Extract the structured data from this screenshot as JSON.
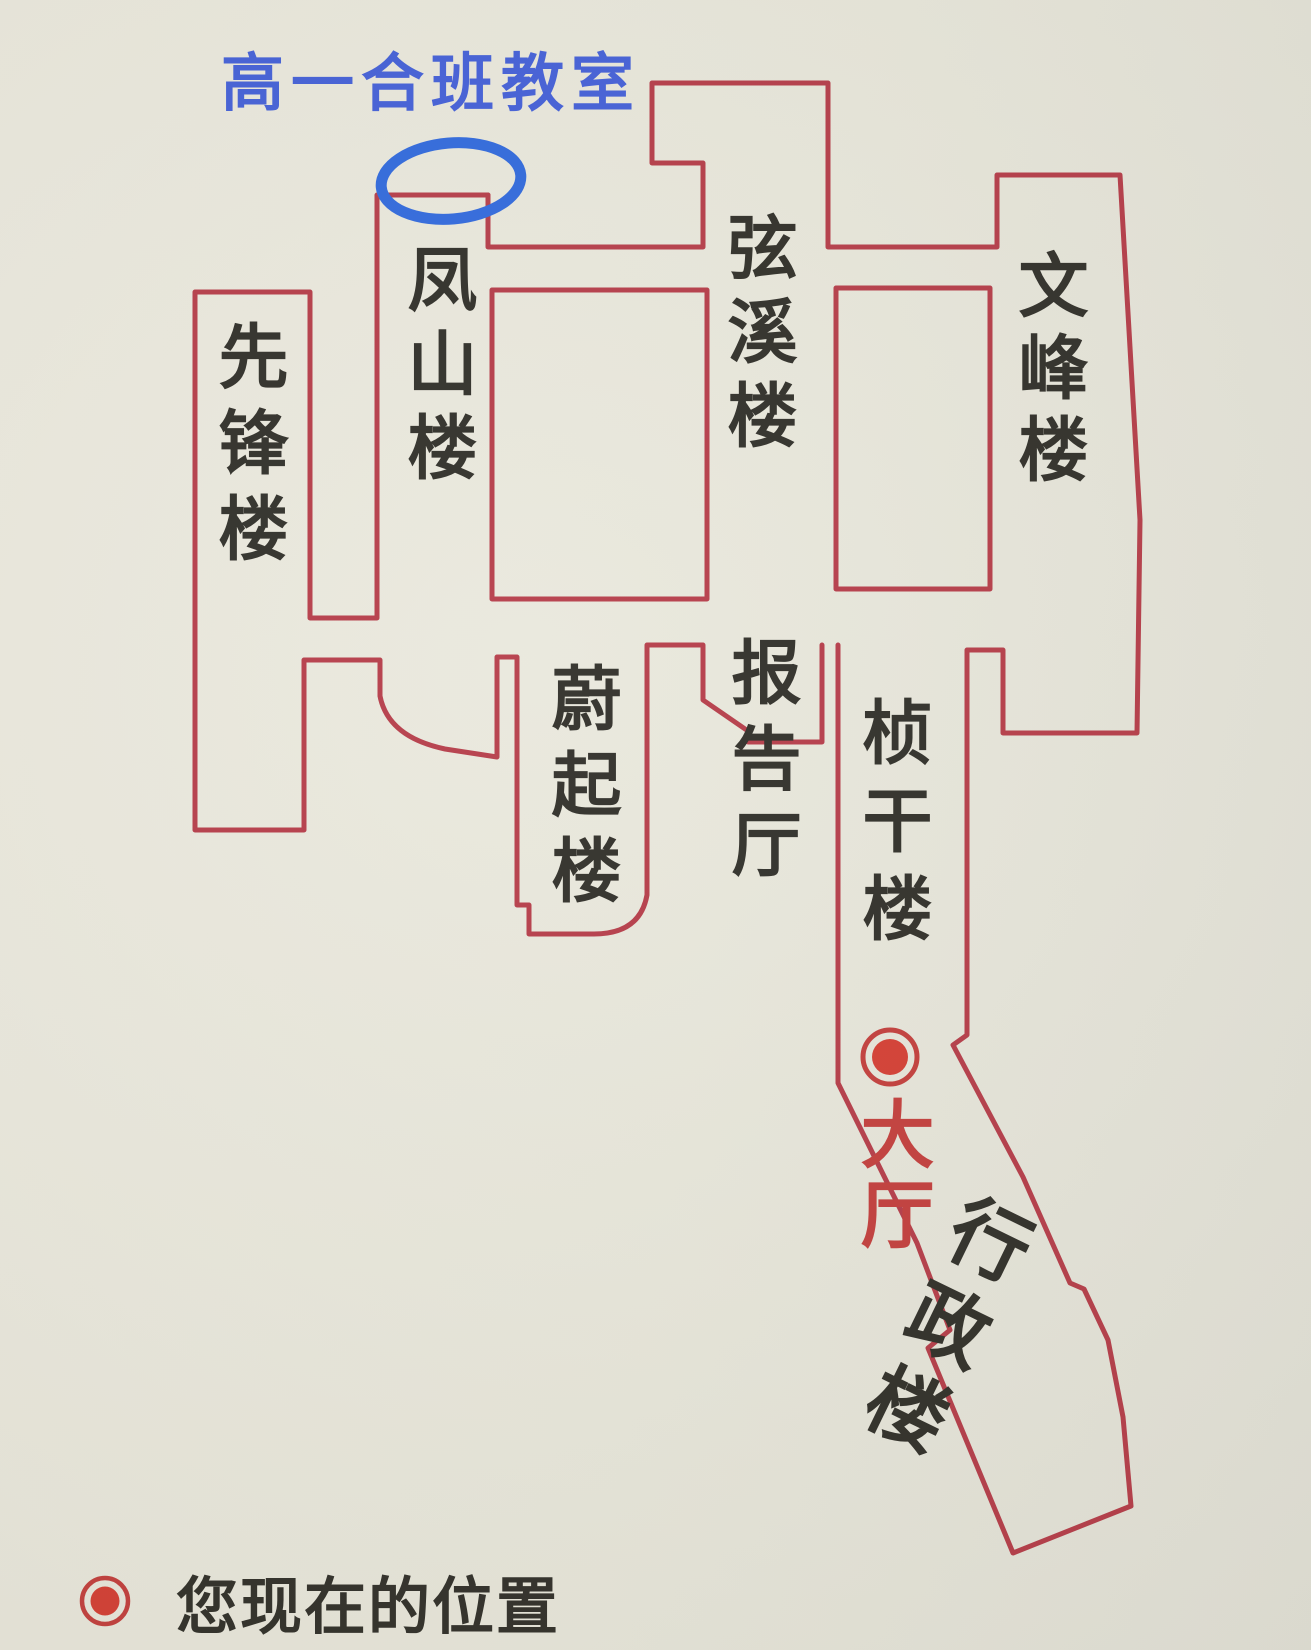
{
  "annotation": {
    "classroom_label": "高一合班教室",
    "circled_spot": "top of Fengshan building"
  },
  "buildings": {
    "xianfeng": {
      "name": "先锋楼"
    },
    "fengshan": {
      "name": "凤山楼"
    },
    "xianxi": {
      "name": "弦溪楼"
    },
    "wenfeng": {
      "name": "文峰楼"
    },
    "weiqi": {
      "name": "蔚起楼"
    },
    "baogaoting": {
      "name": "报告厅"
    },
    "zhengan": {
      "name": "桢干楼"
    },
    "dating": {
      "name": "大厅"
    },
    "xingzheng": {
      "name": "行政楼"
    }
  },
  "legend": {
    "marker": "current-location-dot",
    "text": "您现在的位置"
  },
  "colors": {
    "outline_red": "#b43845",
    "annotation_blue_text": "#3f5cd8",
    "annotation_blue_ellipse": "#2c66dd",
    "hall_red_text": "#c23a38",
    "marker_red": "#d43a2f",
    "text_black": "#2b2a24",
    "paper_background": "#e9e7db"
  }
}
